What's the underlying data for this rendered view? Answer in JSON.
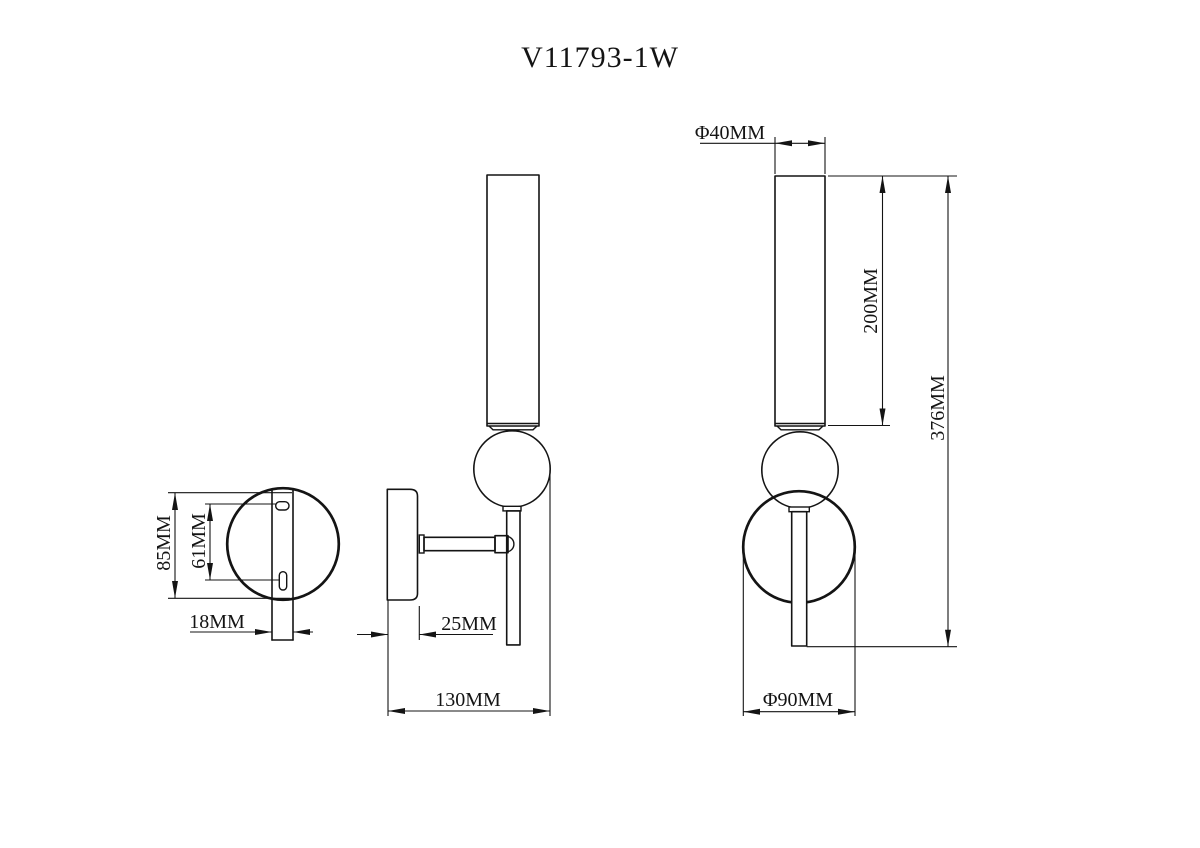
{
  "title": "V11793-1W",
  "colors": {
    "line": "#141414",
    "background": "#ffffff"
  },
  "views": {
    "bracket": {
      "label_height": "85MM",
      "label_slot_spacing": "61MM",
      "label_strip_width": "18MM"
    },
    "side": {
      "label_plate_depth": "25MM",
      "label_total_depth": "130MM"
    },
    "front": {
      "label_tube_diameter": "Φ40MM",
      "label_tube_length": "200MM",
      "label_total_height": "376MM",
      "label_base_diameter": "Φ90MM"
    }
  }
}
